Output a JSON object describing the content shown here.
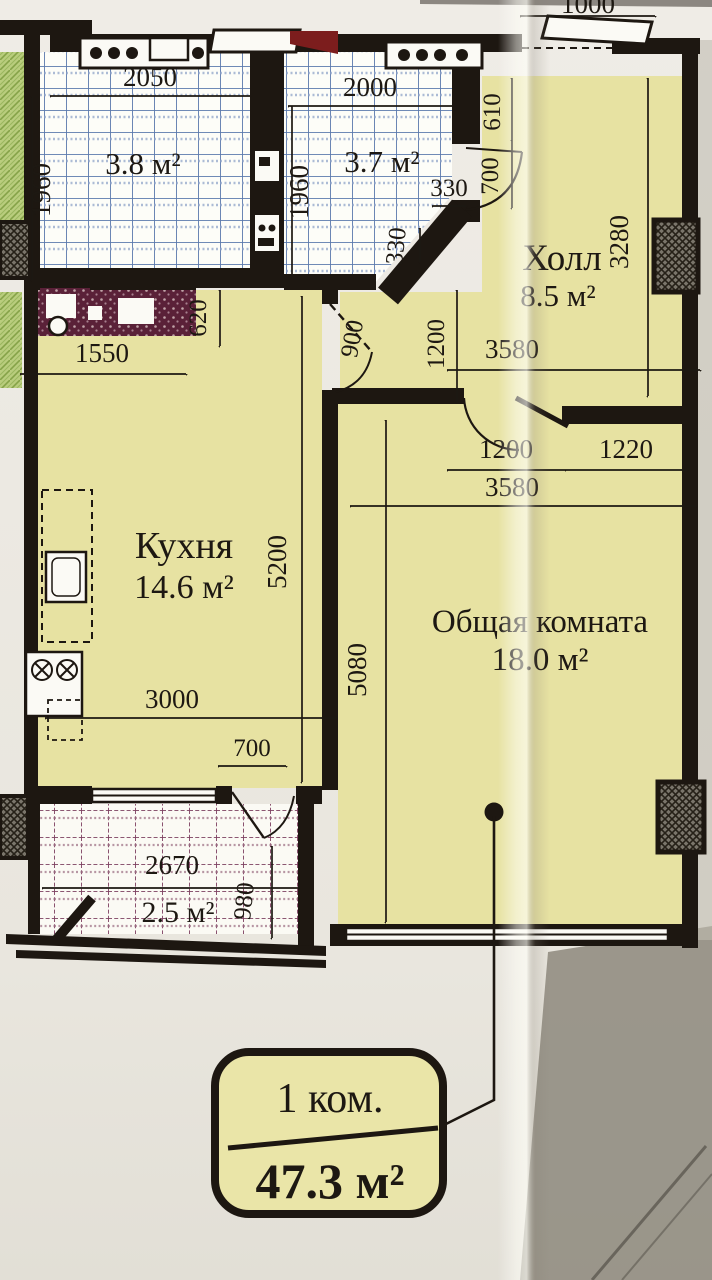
{
  "plan": {
    "badge": {
      "rooms": "1 ком.",
      "area": "47.3 м²"
    },
    "rooms": {
      "bath1": {
        "area": "3.8 м²"
      },
      "bath2": {
        "area": "3.7 м²"
      },
      "hall": {
        "name": "Холл",
        "area": "8.5 м²"
      },
      "kitchen": {
        "name": "Кухня",
        "area": "14.6 м²"
      },
      "living": {
        "name": "Общая комната",
        "area": "18.0 м²"
      },
      "balcony": {
        "area": "2.5 м²"
      }
    },
    "dims": {
      "entry": "1000",
      "bath1_w": "2050",
      "bath1_d": "1960",
      "bath2_w": "2000",
      "bath2_d": "1960",
      "bath2_cut_a": "330",
      "bath2_cut_b": "330",
      "hall_610": "610",
      "hall_door": "700",
      "hall_depth": "3280",
      "hall_w": "3580",
      "kitchen_620": "620",
      "kitchen_1550": "1550",
      "kitchen_door": "900",
      "corridor_h": "1200",
      "living_door": "1200",
      "living_pier": "1220",
      "living_w": "3580",
      "kitchen_d": "5200",
      "living_d": "5080",
      "kitchen_w": "3000",
      "balcony_door": "700",
      "balcony_w": "2670",
      "balcony_d": "980"
    },
    "colors": {
      "paper": "#eae7df",
      "paper-dark": "#908c82",
      "room": "#e7e2a2",
      "wall": "#1d1711",
      "ink": "#1d1812",
      "tile-blue": "#5b79ad",
      "tile-maroon": "#7d4060",
      "hatch-maroon": "#5a2138",
      "green": "#b9cd7d",
      "badge": "#eae5a8"
    }
  }
}
